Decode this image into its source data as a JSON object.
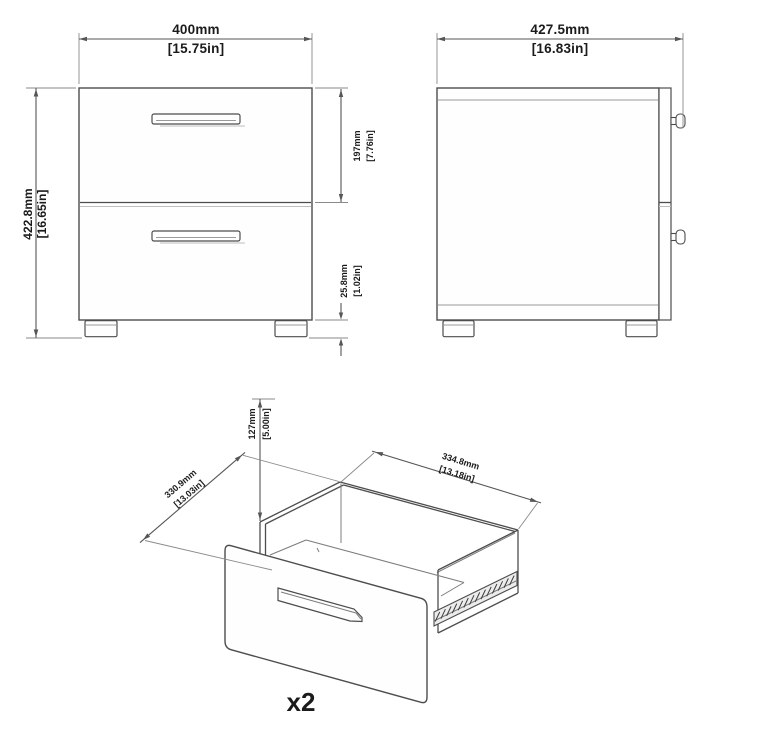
{
  "drawing": {
    "front_view": {
      "width": {
        "mm": "400mm",
        "inch": "[15.75in]"
      },
      "height": {
        "mm": "422.8mm",
        "inch": "[16.65in]"
      },
      "drawer_front": {
        "mm": "197mm",
        "inch": "[7.76in]"
      },
      "base": {
        "mm": "25.8mm",
        "inch": "[1.02in]"
      }
    },
    "side_view": {
      "depth": {
        "mm": "427.5mm",
        "inch": "[16.83in]"
      }
    },
    "drawer_view": {
      "height": {
        "mm": "127mm",
        "inch": "[5.00in]"
      },
      "depth": {
        "mm": "330.9mm",
        "inch": "[13.03in]"
      },
      "width": {
        "mm": "334.8mm",
        "inch": "[13.18in]"
      },
      "quantity": "x2"
    }
  }
}
